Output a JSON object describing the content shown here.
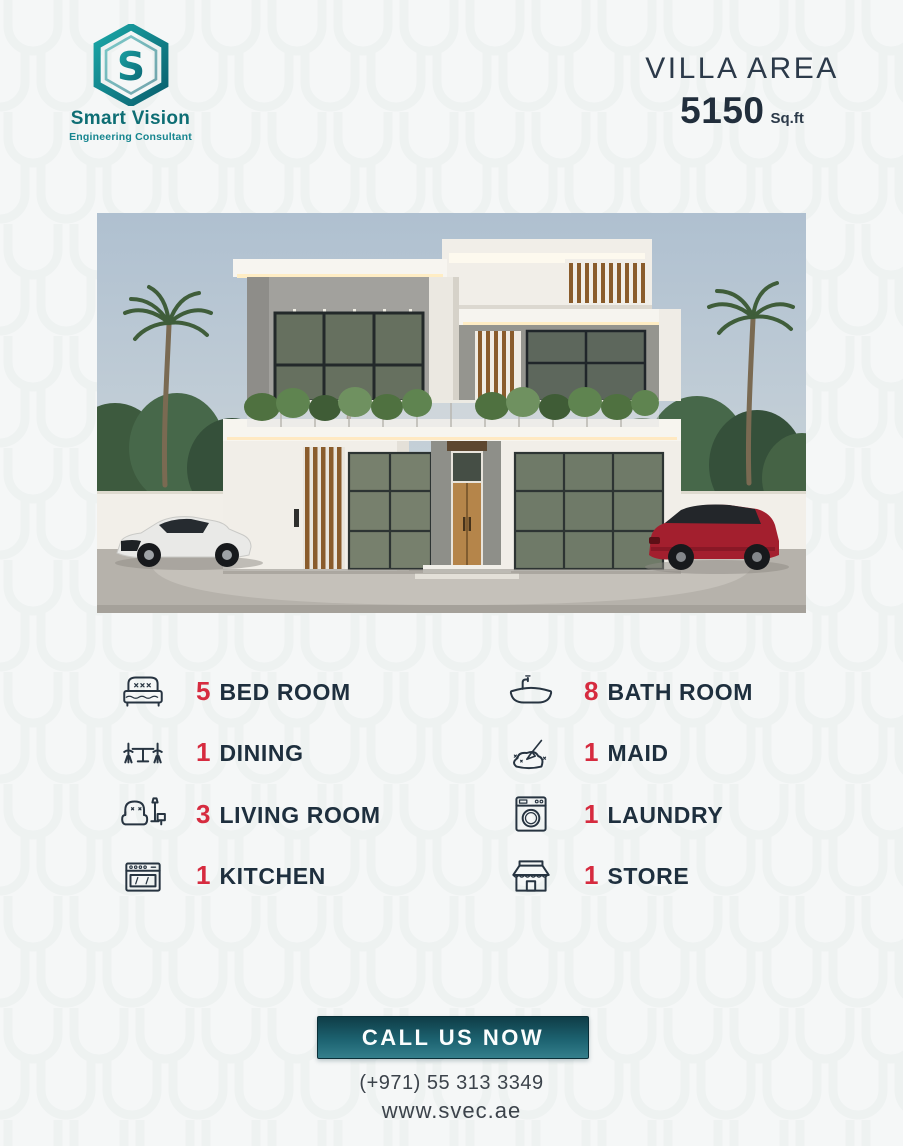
{
  "brand": {
    "name": "Smart Vision",
    "tagline": "Engineering Consultant",
    "logo_icon": "hexagon-s-logo",
    "logo_colors": {
      "teal": "#16939c",
      "teal_dark": "#0a5f6e"
    }
  },
  "header": {
    "title": "VILLA AREA",
    "area_value": "5150",
    "area_unit": "Sq.ft"
  },
  "photo": {
    "description": "modern two-storey villa exterior with palm trees, white sports car and red SUV"
  },
  "features": {
    "left": [
      {
        "count": "5",
        "label": "BED ROOM",
        "icon": "bed-icon"
      },
      {
        "count": "1",
        "label": "DINING",
        "icon": "dining-table-icon"
      },
      {
        "count": "3",
        "label": "LIVING ROOM",
        "icon": "sofa-lamp-icon"
      },
      {
        "count": "1",
        "label": "KITCHEN",
        "icon": "stove-icon"
      }
    ],
    "right": [
      {
        "count": "8",
        "label": "BATH ROOM",
        "icon": "bathtub-icon"
      },
      {
        "count": "1",
        "label": "MAID",
        "icon": "cleaning-icon"
      },
      {
        "count": "1",
        "label": "LAUNDRY",
        "icon": "washing-machine-icon"
      },
      {
        "count": "1",
        "label": "STORE",
        "icon": "storefront-icon"
      }
    ]
  },
  "cta": {
    "label": "CALL US NOW"
  },
  "contact": {
    "phone": "(+971) 55 313 3349",
    "website": "www.svec.ae"
  },
  "colors": {
    "accent_red": "#d62b3f",
    "navy": "#1e2f3e",
    "teal": "#15858f",
    "cta_gradient_top": "#0f3d47",
    "cta_gradient_bottom": "#347f8c",
    "background": "#f5f7f7"
  }
}
